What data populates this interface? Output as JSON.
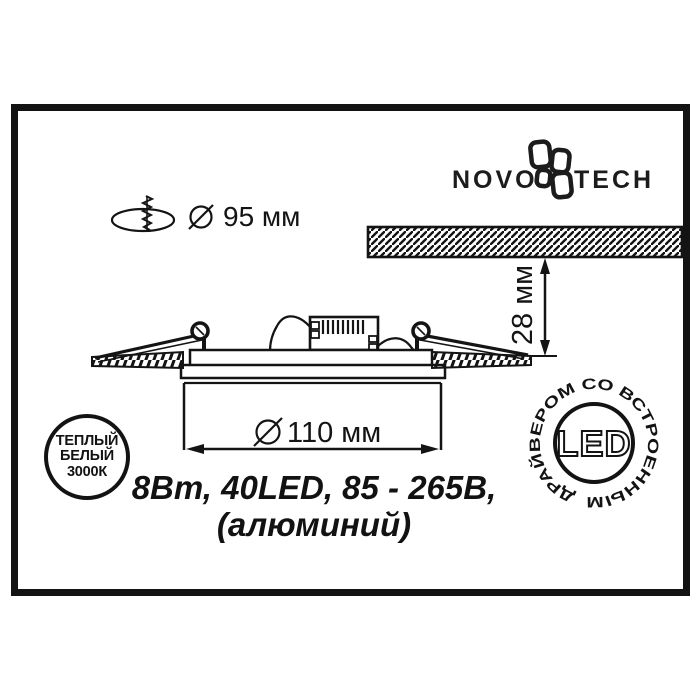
{
  "brand": {
    "left": "NOVO",
    "right": "TECH"
  },
  "dims": {
    "cutout": "95 мм",
    "depth": "28 мм",
    "diameter": "110 мм"
  },
  "specs": {
    "line1": "8Вт, 40LED, 85 - 265В,",
    "line2": "(алюминий)"
  },
  "warm_badge": {
    "line1": "ТЕПЛЫЙ",
    "line2": "БЕЛЫЙ",
    "line3": "3000К"
  },
  "led_badge": {
    "center": "LED",
    "ring": "ДРАЙВЕРОМ СО ВСТРОЕННЫМ"
  },
  "colors": {
    "ink": "#141414",
    "bg": "#ffffff"
  }
}
